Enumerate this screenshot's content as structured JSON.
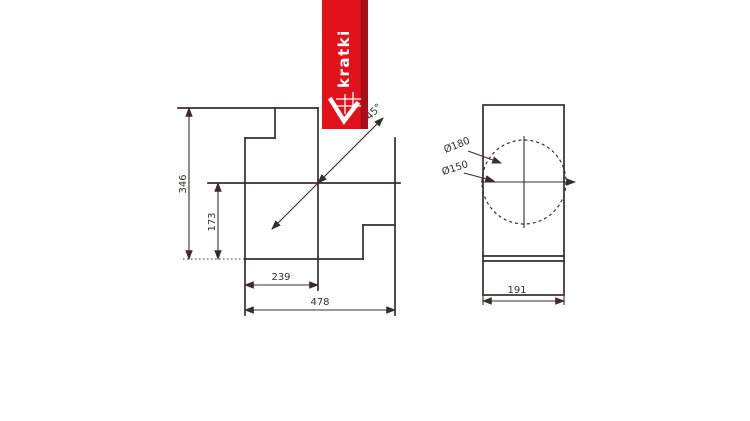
{
  "brand": {
    "logo_text": "kratki"
  },
  "colors": {
    "background": "#ffffff",
    "line": "#392c2d",
    "ribbon_red": "#e2121c",
    "ribbon_shadow": "#a80f16",
    "logo_white": "#ffffff"
  },
  "views": {
    "front": {
      "title": "front-view-technical-drawing",
      "dims": {
        "height_total": "346",
        "height_partial": "173",
        "width_partial": "239",
        "width_total": "478",
        "diagonal_angle": "45°"
      }
    },
    "side": {
      "title": "side-view-technical-drawing",
      "dims": {
        "flue_outer": "Ø180",
        "flue_inner": "Ø150",
        "depth": "191"
      }
    }
  }
}
